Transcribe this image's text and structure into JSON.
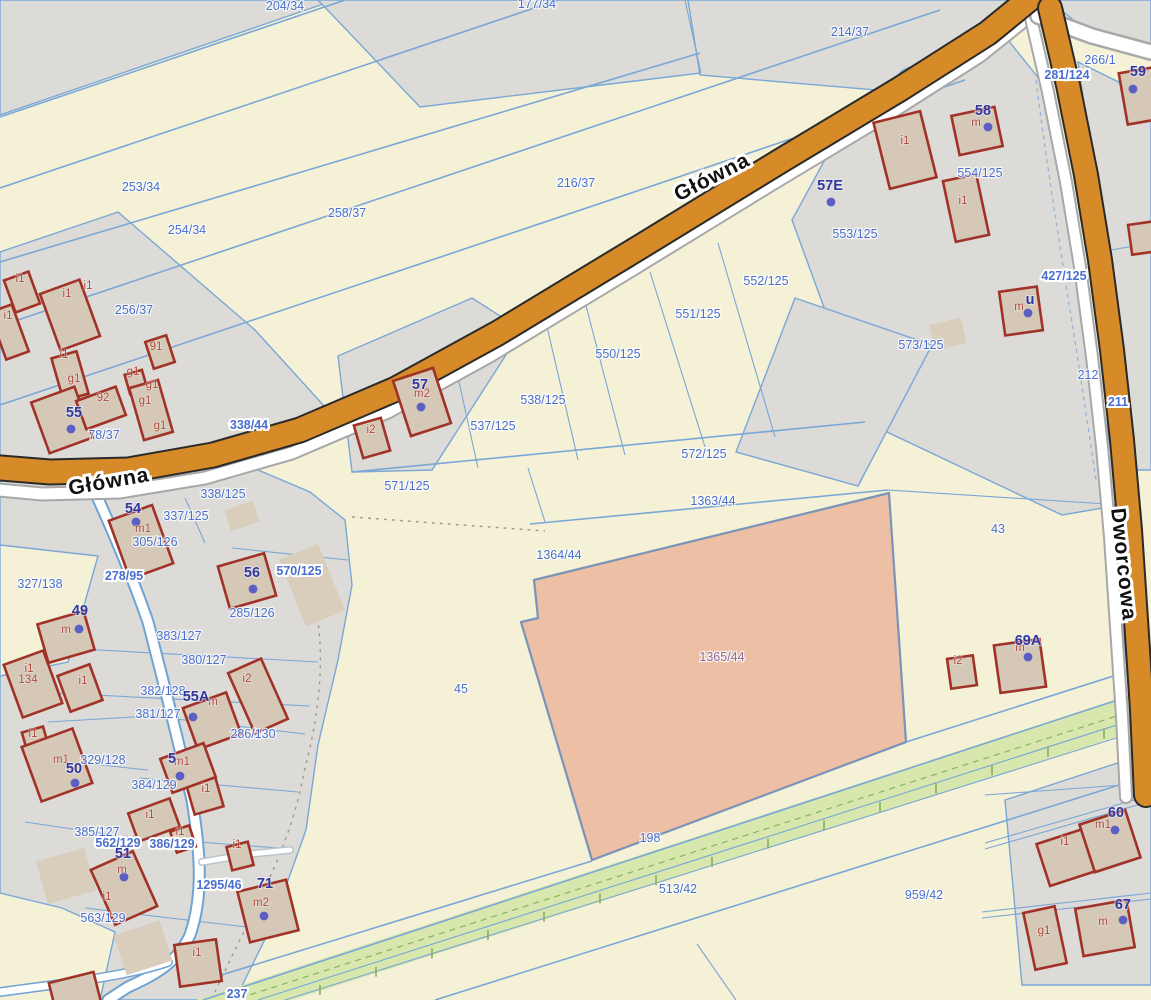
{
  "map": {
    "colors": {
      "background": "#f4f1d6",
      "gray_area": "#dcdbd7",
      "road_orange": "#d68a28",
      "parcel_line_blue": "#7aa7d6",
      "building_red": "#a03227",
      "highlight_parcel_salmon": "#edbfa4",
      "green_strip": "#d7e7ad",
      "parcel_label_blue": "#4a6fce",
      "house_label_navy": "#32379b",
      "building_label_red": "#ae4a40",
      "highlight_label_purple": "#8e6d9a"
    },
    "streets": [
      {
        "t": "Główna",
        "x": 715,
        "y": 183,
        "rot": -27
      },
      {
        "t": "Główna",
        "x": 110,
        "y": 488,
        "rot": -10
      },
      {
        "t": "Dworcowa",
        "x": 1117,
        "y": 565,
        "rot": 84
      }
    ],
    "parcel_labels": [
      {
        "t": "204/34",
        "x": 285,
        "y": 10
      },
      {
        "t": "177/34",
        "x": 537,
        "y": 8
      },
      {
        "t": "214/37",
        "x": 850,
        "y": 36
      },
      {
        "t": "266/1",
        "x": 1100,
        "y": 64
      },
      {
        "t": "281/124",
        "x": 1067,
        "y": 79,
        "halo": true
      },
      {
        "t": "253/34",
        "x": 141,
        "y": 191
      },
      {
        "t": "254/34",
        "x": 187,
        "y": 234
      },
      {
        "t": "258/37",
        "x": 347,
        "y": 217
      },
      {
        "t": "216/37",
        "x": 576,
        "y": 187
      },
      {
        "t": "256/37",
        "x": 134,
        "y": 314
      },
      {
        "t": "552/125",
        "x": 766,
        "y": 285
      },
      {
        "t": "551/125",
        "x": 698,
        "y": 318
      },
      {
        "t": "550/125",
        "x": 618,
        "y": 358
      },
      {
        "t": "553/125",
        "x": 855,
        "y": 238
      },
      {
        "t": "554/125",
        "x": 980,
        "y": 177
      },
      {
        "t": "573/125",
        "x": 921,
        "y": 349
      },
      {
        "t": "427/125",
        "x": 1064,
        "y": 280,
        "halo": true
      },
      {
        "t": "538/125",
        "x": 543,
        "y": 404
      },
      {
        "t": "537/125",
        "x": 493,
        "y": 430
      },
      {
        "t": "572/125",
        "x": 704,
        "y": 458
      },
      {
        "t": "571/125",
        "x": 407,
        "y": 490
      },
      {
        "t": "1363/44",
        "x": 713,
        "y": 505
      },
      {
        "t": "1364/44",
        "x": 559,
        "y": 559
      },
      {
        "t": "43",
        "x": 998,
        "y": 533
      },
      {
        "t": "45",
        "x": 461,
        "y": 693
      },
      {
        "t": "198",
        "x": 650,
        "y": 842
      },
      {
        "t": "513/42",
        "x": 678,
        "y": 893
      },
      {
        "t": "959/42",
        "x": 924,
        "y": 899
      },
      {
        "t": "212",
        "x": 1088,
        "y": 379
      },
      {
        "t": "211",
        "x": 1118,
        "y": 406,
        "halo": true
      },
      {
        "t": "338/44",
        "x": 249,
        "y": 429,
        "halo": true
      },
      {
        "t": "338/125",
        "x": 223,
        "y": 498
      },
      {
        "t": "337/125",
        "x": 186,
        "y": 520
      },
      {
        "t": "305/126",
        "x": 155,
        "y": 546
      },
      {
        "t": "278/95",
        "x": 124,
        "y": 580,
        "halo": true
      },
      {
        "t": "327/138",
        "x": 40,
        "y": 588
      },
      {
        "t": "570/125",
        "x": 299,
        "y": 575,
        "halo": true
      },
      {
        "t": "285/126",
        "x": 252,
        "y": 617
      },
      {
        "t": "383/127",
        "x": 179,
        "y": 640
      },
      {
        "t": "380/127",
        "x": 204,
        "y": 664
      },
      {
        "t": "382/128",
        "x": 163,
        "y": 695
      },
      {
        "t": "381/127",
        "x": 158,
        "y": 718
      },
      {
        "t": "329/128",
        "x": 103,
        "y": 764
      },
      {
        "t": "286/130",
        "x": 253,
        "y": 738
      },
      {
        "t": "384/129",
        "x": 154,
        "y": 789
      },
      {
        "t": "385/127",
        "x": 97,
        "y": 836
      },
      {
        "t": "562/129",
        "x": 118,
        "y": 847,
        "halo": true
      },
      {
        "t": "386/129",
        "x": 172,
        "y": 848,
        "halo": true
      },
      {
        "t": "563/129",
        "x": 103,
        "y": 922
      },
      {
        "t": "1295/46",
        "x": 219,
        "y": 889,
        "halo": true
      },
      {
        "t": "78/37",
        "x": 104,
        "y": 439
      },
      {
        "t": "237",
        "x": 237,
        "y": 998,
        "halo": true
      },
      {
        "t": "1365/44",
        "x": 722,
        "y": 661,
        "c": "#8e6d9a"
      }
    ],
    "house_labels": [
      {
        "t": "54",
        "x": 133,
        "y": 513
      },
      {
        "t": "55",
        "x": 74,
        "y": 417
      },
      {
        "t": "56",
        "x": 252,
        "y": 577
      },
      {
        "t": "57",
        "x": 420,
        "y": 389
      },
      {
        "t": "57E",
        "x": 830,
        "y": 190
      },
      {
        "t": "58",
        "x": 983,
        "y": 115
      },
      {
        "t": "59",
        "x": 1138,
        "y": 76
      },
      {
        "t": "49",
        "x": 80,
        "y": 615
      },
      {
        "t": "50",
        "x": 74,
        "y": 773
      },
      {
        "t": "5",
        "x": 172,
        "y": 763
      },
      {
        "t": "51",
        "x": 123,
        "y": 858
      },
      {
        "t": "55A",
        "x": 196,
        "y": 701
      },
      {
        "t": "71",
        "x": 265,
        "y": 888
      },
      {
        "t": "69A",
        "x": 1028,
        "y": 645
      },
      {
        "t": "60",
        "x": 1116,
        "y": 817
      },
      {
        "t": "67",
        "x": 1123,
        "y": 909
      },
      {
        "t": "u",
        "x": 1030,
        "y": 304
      }
    ],
    "building_labels": [
      {
        "t": "i1",
        "x": 20,
        "y": 282
      },
      {
        "t": "i1",
        "x": 67,
        "y": 297
      },
      {
        "t": "i1",
        "x": 88,
        "y": 289
      },
      {
        "t": "i1",
        "x": 8,
        "y": 319
      },
      {
        "t": "i1",
        "x": 64,
        "y": 358
      },
      {
        "t": "i1",
        "x": 905,
        "y": 144
      },
      {
        "t": "i1",
        "x": 963,
        "y": 204
      },
      {
        "t": "i1",
        "x": 29,
        "y": 672
      },
      {
        "t": "i1",
        "x": 83,
        "y": 684
      },
      {
        "t": "i1",
        "x": 33,
        "y": 737
      },
      {
        "t": "i1",
        "x": 150,
        "y": 818
      },
      {
        "t": "i1",
        "x": 180,
        "y": 835
      },
      {
        "t": "i1",
        "x": 206,
        "y": 792
      },
      {
        "t": "i1",
        "x": 107,
        "y": 900
      },
      {
        "t": "i1",
        "x": 197,
        "y": 956
      },
      {
        "t": "i1",
        "x": 237,
        "y": 848
      },
      {
        "t": "i1",
        "x": 1065,
        "y": 845
      },
      {
        "t": "g1",
        "x": 74,
        "y": 382
      },
      {
        "t": "g1",
        "x": 133,
        "y": 375
      },
      {
        "t": "g1",
        "x": 152,
        "y": 388
      },
      {
        "t": "g1",
        "x": 145,
        "y": 404
      },
      {
        "t": "g1",
        "x": 160,
        "y": 429
      },
      {
        "t": "g1",
        "x": 1044,
        "y": 934
      },
      {
        "t": "91",
        "x": 156,
        "y": 350
      },
      {
        "t": "92",
        "x": 103,
        "y": 401
      },
      {
        "t": "i2",
        "x": 371,
        "y": 433
      },
      {
        "t": "i2",
        "x": 247,
        "y": 682
      },
      {
        "t": "i2",
        "x": 958,
        "y": 664
      },
      {
        "t": "m2",
        "x": 422,
        "y": 397
      },
      {
        "t": "m2",
        "x": 261,
        "y": 906
      },
      {
        "t": "m1",
        "x": 143,
        "y": 532
      },
      {
        "t": "m1",
        "x": 61,
        "y": 763
      },
      {
        "t": "m1",
        "x": 182,
        "y": 765
      },
      {
        "t": "m1",
        "x": 1103,
        "y": 828
      },
      {
        "t": "m",
        "x": 66,
        "y": 633
      },
      {
        "t": "m",
        "x": 213,
        "y": 705
      },
      {
        "t": "m",
        "x": 122,
        "y": 873
      },
      {
        "t": "m",
        "x": 1020,
        "y": 651
      },
      {
        "t": "m",
        "x": 1103,
        "y": 925
      },
      {
        "t": "m",
        "x": 976,
        "y": 126
      },
      {
        "t": "m",
        "x": 1019,
        "y": 310
      },
      {
        "t": "134",
        "x": 28,
        "y": 683
      }
    ],
    "dots": [
      {
        "x": 71,
        "y": 429
      },
      {
        "x": 136,
        "y": 522
      },
      {
        "x": 253,
        "y": 589
      },
      {
        "x": 421,
        "y": 407
      },
      {
        "x": 831,
        "y": 202
      },
      {
        "x": 988,
        "y": 127
      },
      {
        "x": 1133,
        "y": 89
      },
      {
        "x": 1028,
        "y": 313
      },
      {
        "x": 79,
        "y": 629
      },
      {
        "x": 75,
        "y": 783
      },
      {
        "x": 180,
        "y": 776
      },
      {
        "x": 193,
        "y": 717
      },
      {
        "x": 124,
        "y": 877
      },
      {
        "x": 264,
        "y": 916
      },
      {
        "x": 1028,
        "y": 657
      },
      {
        "x": 1115,
        "y": 830
      },
      {
        "x": 1123,
        "y": 920
      }
    ]
  }
}
